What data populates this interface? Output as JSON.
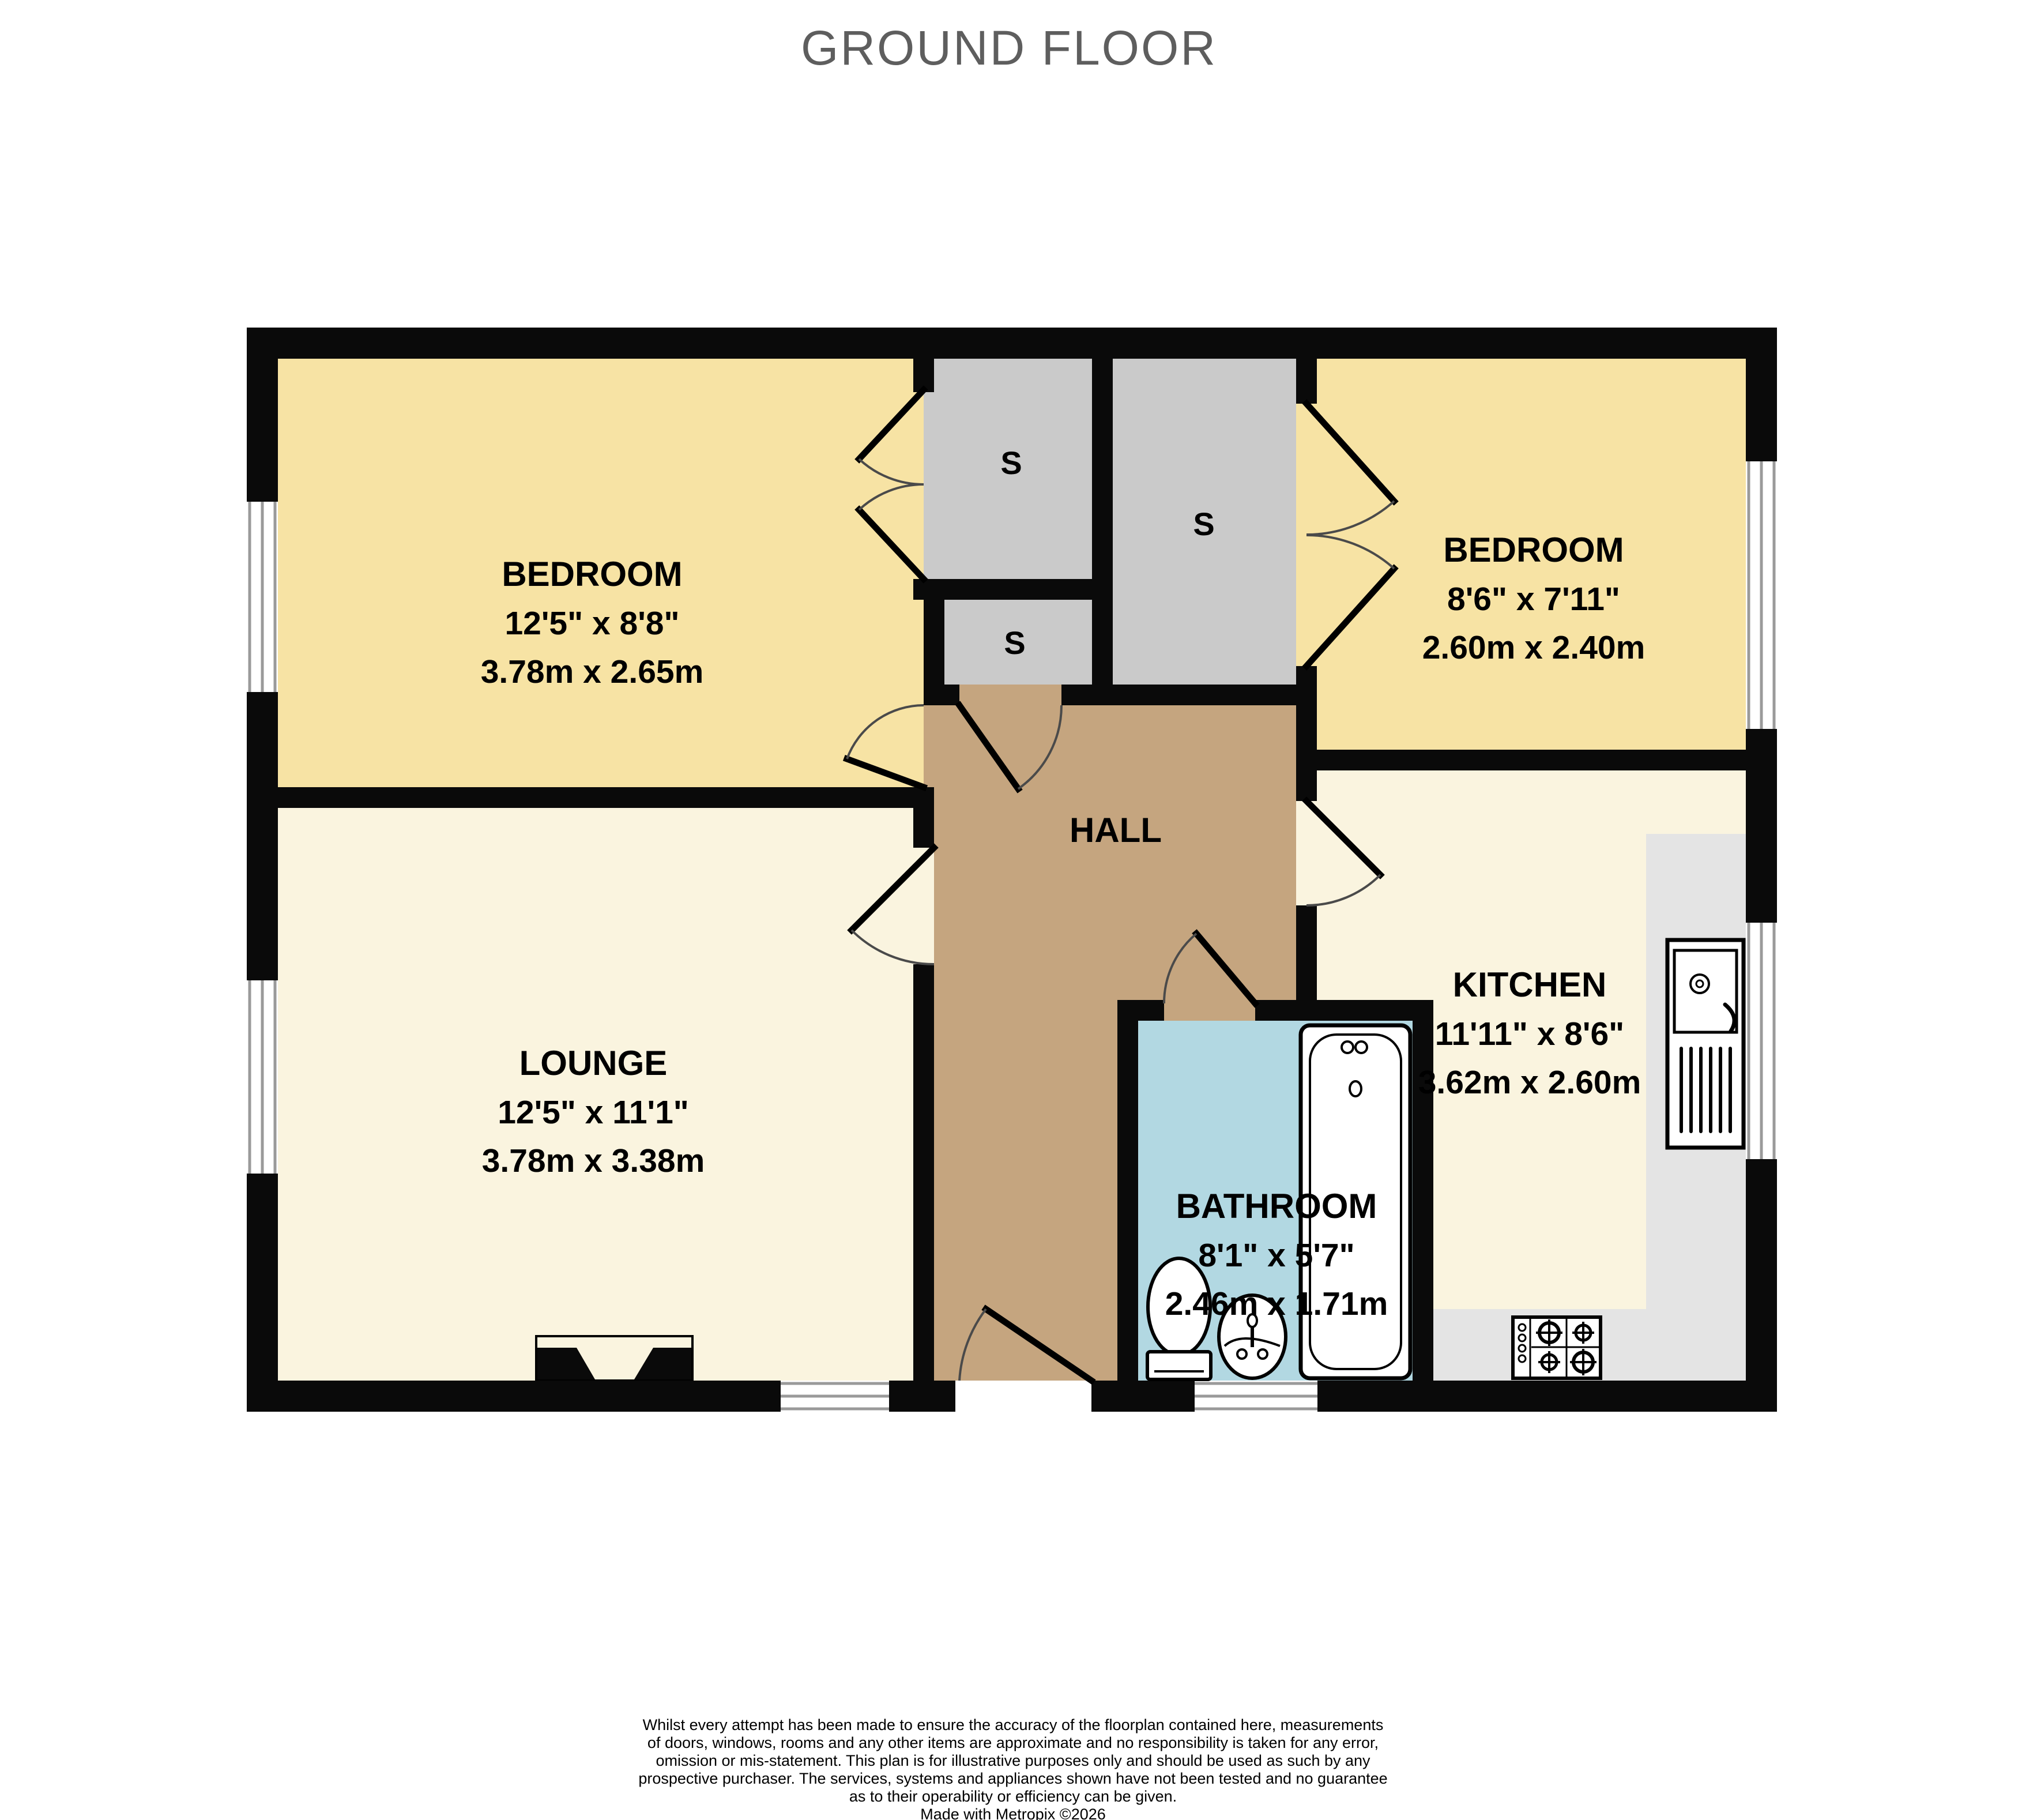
{
  "title": "GROUND FLOOR",
  "rooms": {
    "bedroom1": {
      "name": "BEDROOM",
      "imperial": "12'5\"  x 8'8\"",
      "metric": "3.78m  x 2.65m"
    },
    "bedroom2": {
      "name": "BEDROOM",
      "imperial": "8'6\"  x 7'11\"",
      "metric": "2.60m  x 2.40m"
    },
    "lounge": {
      "name": "LOUNGE",
      "imperial": "12'5\"  x 11'1\"",
      "metric": "3.78m  x 3.38m"
    },
    "kitchen": {
      "name": "KITCHEN",
      "imperial": "11'11\"  x 8'6\"",
      "metric": "3.62m  x 2.60m"
    },
    "bathroom": {
      "name": "BATHROOM",
      "imperial": "8'1\"  x 5'7\"",
      "metric": "2.46m  x 1.71m"
    },
    "hall": {
      "name": "HALL"
    }
  },
  "storage": {
    "label": "S"
  },
  "footer": {
    "lines": [
      "Whilst every attempt has been made to ensure the accuracy of the floorplan contained here, measurements",
      "of doors, windows, rooms and any other items are approximate and no responsibility is taken for any error,",
      "omission or mis-statement. This plan is for illustrative purposes only and should be used as such by any",
      "prospective purchaser. The services, systems and appliances shown have not been tested and no guarantee",
      "as to their operability or efficiency can be given.",
      "Made with Metropix ©2026"
    ]
  },
  "colors": {
    "bedroom": "#F7E3A4",
    "living": "#FAF4DF",
    "hall": "#C5A57F",
    "storage": "#CACACA",
    "bathroom": "#B2D8E2",
    "counter": "#E4E4E4",
    "wall": "#0A0A0A",
    "window_frame": "#9A9A9A",
    "title": "#5E5E5E"
  }
}
